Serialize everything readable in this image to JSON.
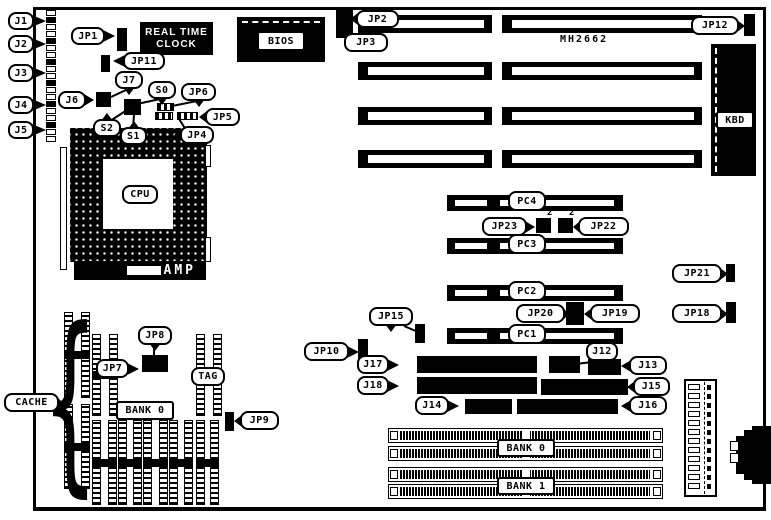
{
  "labels": {
    "chipset": "MH2662",
    "rtc_line1": "REAL TIME",
    "rtc_line2": "CLOCK",
    "amp": "AMP",
    "sup_jp23": "2",
    "sup_jp22": "2"
  },
  "callouts": [
    {
      "id": "j1",
      "label": "J1",
      "x": 8,
      "y": 12,
      "w": 26,
      "h": 18,
      "dir": "right",
      "len": 14
    },
    {
      "id": "j2",
      "label": "J2",
      "x": 8,
      "y": 35,
      "w": 26,
      "h": 18,
      "dir": "right",
      "len": 14
    },
    {
      "id": "j3",
      "label": "J3",
      "x": 8,
      "y": 64,
      "w": 26,
      "h": 18,
      "dir": "right",
      "len": 14
    },
    {
      "id": "j4",
      "label": "J4",
      "x": 8,
      "y": 96,
      "w": 26,
      "h": 18,
      "dir": "right",
      "len": 14
    },
    {
      "id": "j5",
      "label": "J5",
      "x": 8,
      "y": 121,
      "w": 26,
      "h": 18,
      "dir": "right",
      "len": 14
    },
    {
      "id": "jp1",
      "label": "JP1",
      "x": 71,
      "y": 27,
      "w": 34,
      "h": 18,
      "dir": "right",
      "len": 12
    },
    {
      "id": "jp11",
      "label": "JP11",
      "x": 123,
      "y": 52,
      "w": 42,
      "h": 18,
      "dir": "left",
      "len": 12
    },
    {
      "id": "j7",
      "label": "J7",
      "x": 115,
      "y": 71,
      "w": 28,
      "h": 18,
      "dir": "down",
      "len": 8
    },
    {
      "id": "j6",
      "label": "J6",
      "x": 58,
      "y": 91,
      "w": 28,
      "h": 18,
      "dir": "right",
      "len": 10
    },
    {
      "id": "s0",
      "label": "S0",
      "x": 148,
      "y": 81,
      "w": 28,
      "h": 18,
      "dir": "down",
      "len": 8
    },
    {
      "id": "jp6",
      "label": "JP6",
      "x": 181,
      "y": 83,
      "w": 35,
      "h": 18,
      "dir": "down",
      "len": 8
    },
    {
      "id": "jp5",
      "label": "JP5",
      "x": 205,
      "y": 108,
      "w": 35,
      "h": 18,
      "dir": "left",
      "len": 8
    },
    {
      "id": "s2",
      "label": "S2",
      "x": 93,
      "y": 119,
      "w": 28,
      "h": 18,
      "dir": "up",
      "len": 8
    },
    {
      "id": "s1",
      "label": "S1",
      "x": 120,
      "y": 127,
      "w": 27,
      "h": 18,
      "dir": "up",
      "len": 8
    },
    {
      "id": "jp4",
      "label": "JP4",
      "x": 180,
      "y": 126,
      "w": 34,
      "h": 18,
      "dir": "left",
      "len": 8
    },
    {
      "id": "jp2",
      "label": "JP2",
      "x": 356,
      "y": 10,
      "w": 43,
      "h": 18,
      "dir": "left",
      "len": 8
    },
    {
      "id": "jp3",
      "label": "JP3",
      "x": 344,
      "y": 33,
      "w": 44,
      "h": 19,
      "dir": "up",
      "len": 8
    },
    {
      "id": "jp12",
      "label": "JP12",
      "x": 691,
      "y": 16,
      "w": 48,
      "h": 19,
      "dir": "right",
      "len": 8
    },
    {
      "id": "jp23",
      "label": "JP23",
      "x": 482,
      "y": 217,
      "w": 45,
      "h": 19,
      "dir": "right",
      "len": 10
    },
    {
      "id": "jp22",
      "label": "JP22",
      "x": 578,
      "y": 217,
      "w": 51,
      "h": 19,
      "dir": "left",
      "len": 7
    },
    {
      "id": "jp21",
      "label": "JP21",
      "x": 672,
      "y": 264,
      "w": 50,
      "h": 19,
      "dir": "right",
      "len": 8
    },
    {
      "id": "jp20",
      "label": "JP20",
      "x": 516,
      "y": 304,
      "w": 49,
      "h": 19,
      "dir": "right",
      "len": 6
    },
    {
      "id": "jp19",
      "label": "JP19",
      "x": 590,
      "y": 304,
      "w": 50,
      "h": 19,
      "dir": "left",
      "len": 8
    },
    {
      "id": "jp18",
      "label": "JP18",
      "x": 672,
      "y": 304,
      "w": 50,
      "h": 19,
      "dir": "right",
      "len": 8
    },
    {
      "id": "jp15",
      "label": "JP15",
      "x": 369,
      "y": 307,
      "w": 44,
      "h": 19,
      "dir": "down",
      "len": 8
    },
    {
      "id": "jp10",
      "label": "JP10",
      "x": 304,
      "y": 342,
      "w": 45,
      "h": 19,
      "dir": "right",
      "len": 12
    },
    {
      "id": "j17",
      "label": "J17",
      "x": 357,
      "y": 355,
      "w": 32,
      "h": 19,
      "dir": "right",
      "len": 12
    },
    {
      "id": "j12",
      "label": "J12",
      "x": 586,
      "y": 342,
      "w": 32,
      "h": 19,
      "dir": "down",
      "len": 8
    },
    {
      "id": "j13",
      "label": "J13",
      "x": 629,
      "y": 356,
      "w": 38,
      "h": 19,
      "dir": "left",
      "len": 10
    },
    {
      "id": "j18",
      "label": "J18",
      "x": 357,
      "y": 376,
      "w": 32,
      "h": 19,
      "dir": "right",
      "len": 12
    },
    {
      "id": "j15",
      "label": "J15",
      "x": 633,
      "y": 377,
      "w": 37,
      "h": 19,
      "dir": "left",
      "len": 8
    },
    {
      "id": "j14",
      "label": "J14",
      "x": 415,
      "y": 396,
      "w": 34,
      "h": 19,
      "dir": "right",
      "len": 12
    },
    {
      "id": "j16",
      "label": "J16",
      "x": 629,
      "y": 396,
      "w": 38,
      "h": 19,
      "dir": "left",
      "len": 10
    },
    {
      "id": "jp7",
      "label": "JP7",
      "x": 96,
      "y": 359,
      "w": 33,
      "h": 19,
      "dir": "right",
      "len": 12
    },
    {
      "id": "jp8",
      "label": "JP8",
      "x": 138,
      "y": 326,
      "w": 34,
      "h": 19,
      "dir": "down",
      "len": 8
    },
    {
      "id": "jp9",
      "label": "JP9",
      "x": 240,
      "y": 411,
      "w": 39,
      "h": 19,
      "dir": "left",
      "len": 8
    },
    {
      "id": "cache",
      "label": "CACHE",
      "x": 4,
      "y": 393,
      "w": 55,
      "h": 19,
      "dir": "right",
      "len": 6
    },
    {
      "id": "tag",
      "label": "TAG",
      "x": 191,
      "y": 367,
      "w": 34,
      "h": 19,
      "dir": "none"
    },
    {
      "id": "cpu",
      "label": "CPU",
      "x": 122,
      "y": 185,
      "w": 36,
      "h": 19,
      "dir": "none"
    },
    {
      "id": "bios",
      "label": "BIOS",
      "x": 257,
      "y": 31,
      "w": 48,
      "h": 20,
      "dir": "none"
    },
    {
      "id": "kbd",
      "label": "KBD",
      "x": 716,
      "y": 111,
      "w": 38,
      "h": 18,
      "dir": "none"
    },
    {
      "id": "pc4",
      "label": "PC4",
      "x": 508,
      "y": 191,
      "w": 38,
      "h": 20,
      "dir": "none"
    },
    {
      "id": "pc3",
      "label": "PC3",
      "x": 508,
      "y": 234,
      "w": 38,
      "h": 20,
      "dir": "none"
    },
    {
      "id": "pc2",
      "label": "PC2",
      "x": 508,
      "y": 281,
      "w": 38,
      "h": 20,
      "dir": "none"
    },
    {
      "id": "pc1",
      "label": "PC1",
      "x": 508,
      "y": 324,
      "w": 38,
      "h": 20,
      "dir": "none"
    },
    {
      "id": "bank0-cache",
      "label": "BANK 0",
      "x": 116,
      "y": 401,
      "w": 58,
      "h": 19,
      "dir": "none"
    },
    {
      "id": "bank0",
      "label": "BANK 0",
      "x": 497,
      "y": 439,
      "w": 58,
      "h": 18,
      "dir": "none"
    },
    {
      "id": "bank1",
      "label": "BANK 1",
      "x": 497,
      "y": 477,
      "w": 58,
      "h": 18,
      "dir": "none"
    }
  ],
  "jumpers": [
    {
      "id": "jp1-j",
      "x": 117,
      "y": 28,
      "w": 10,
      "h": 23,
      "t": "v"
    },
    {
      "id": "jp11-j",
      "x": 101,
      "y": 55,
      "w": 9,
      "h": 17,
      "t": "v"
    },
    {
      "id": "j6-j",
      "x": 96,
      "y": 92,
      "w": 15,
      "h": 15,
      "t": "g"
    },
    {
      "id": "s-block",
      "x": 124,
      "y": 99,
      "w": 17,
      "h": 16,
      "t": "g"
    },
    {
      "id": "jp6-j",
      "x": 157,
      "y": 103,
      "w": 17,
      "h": 8,
      "t": "h"
    },
    {
      "id": "jp5-j1",
      "x": 155,
      "y": 112,
      "w": 18,
      "h": 8,
      "t": "h"
    },
    {
      "id": "jp5-j2",
      "x": 177,
      "y": 112,
      "w": 21,
      "h": 8,
      "t": "h"
    },
    {
      "id": "jp2-j",
      "x": 336,
      "y": 8,
      "w": 17,
      "h": 30,
      "t": "v"
    },
    {
      "id": "jp12-j",
      "x": 744,
      "y": 14,
      "w": 11,
      "h": 22,
      "t": "v"
    },
    {
      "id": "jp23-j",
      "x": 536,
      "y": 218,
      "w": 15,
      "h": 15,
      "t": "g"
    },
    {
      "id": "jp22-j",
      "x": 558,
      "y": 218,
      "w": 15,
      "h": 15,
      "t": "g"
    },
    {
      "id": "jp21-j",
      "x": 726,
      "y": 264,
      "w": 9,
      "h": 18,
      "t": "v"
    },
    {
      "id": "jp20-j",
      "x": 566,
      "y": 302,
      "w": 18,
      "h": 23,
      "t": "v"
    },
    {
      "id": "jp18-j",
      "x": 726,
      "y": 302,
      "w": 10,
      "h": 21,
      "t": "v"
    },
    {
      "id": "jp15-j",
      "x": 415,
      "y": 324,
      "w": 10,
      "h": 19,
      "t": "v"
    },
    {
      "id": "jp10-j",
      "x": 358,
      "y": 339,
      "w": 10,
      "h": 24,
      "t": "v"
    },
    {
      "id": "jp78-j",
      "x": 142,
      "y": 355,
      "w": 26,
      "h": 17,
      "t": "g"
    },
    {
      "id": "jp9-j",
      "x": 225,
      "y": 412,
      "w": 9,
      "h": 19,
      "t": "v"
    }
  ],
  "headers": [
    {
      "id": "j17-h",
      "x": 417,
      "y": 356,
      "w": 120,
      "h": 17,
      "cols": 15
    },
    {
      "id": "j12-h",
      "x": 549,
      "y": 356,
      "w": 31,
      "h": 17,
      "cols": 4
    },
    {
      "id": "j13-h",
      "x": 588,
      "y": 359,
      "w": 33,
      "h": 16,
      "cols": 4
    },
    {
      "id": "j18-h",
      "x": 417,
      "y": 377,
      "w": 120,
      "h": 17,
      "cols": 15
    },
    {
      "id": "j15-h",
      "x": 541,
      "y": 379,
      "w": 87,
      "h": 16,
      "cols": 11
    },
    {
      "id": "j14-h",
      "x": 465,
      "y": 399,
      "w": 47,
      "h": 15,
      "cols": 6
    },
    {
      "id": "j16-h",
      "x": 517,
      "y": 399,
      "w": 101,
      "h": 15,
      "cols": 13
    }
  ],
  "isa_slots": [
    {
      "x": 358,
      "y": 15,
      "w": 134,
      "h": 18
    },
    {
      "x": 502,
      "y": 15,
      "w": 200,
      "h": 18
    },
    {
      "x": 358,
      "y": 62,
      "w": 134,
      "h": 18
    },
    {
      "x": 502,
      "y": 62,
      "w": 200,
      "h": 18
    },
    {
      "x": 358,
      "y": 107,
      "w": 134,
      "h": 18
    },
    {
      "x": 502,
      "y": 107,
      "w": 200,
      "h": 18
    },
    {
      "x": 358,
      "y": 150,
      "w": 134,
      "h": 18
    },
    {
      "x": 502,
      "y": 150,
      "w": 200,
      "h": 18
    }
  ],
  "pci_slots": [
    {
      "x": 447,
      "y": 195,
      "w": 176,
      "h": 16
    },
    {
      "x": 447,
      "y": 238,
      "w": 176,
      "h": 16
    },
    {
      "x": 447,
      "y": 285,
      "w": 176,
      "h": 16
    },
    {
      "x": 447,
      "y": 328,
      "w": 176,
      "h": 16
    }
  ],
  "simm_slots": [
    {
      "x": 388,
      "y": 428,
      "w": 275,
      "h": 15
    },
    {
      "x": 388,
      "y": 446,
      "w": 275,
      "h": 15
    },
    {
      "x": 388,
      "y": 467,
      "w": 275,
      "h": 15
    },
    {
      "x": 388,
      "y": 484,
      "w": 275,
      "h": 15
    }
  ],
  "cache_chips": [
    {
      "x": 64,
      "y": 312,
      "w": 26,
      "h": 86
    },
    {
      "x": 64,
      "y": 404,
      "w": 26,
      "h": 85
    },
    {
      "x": 92,
      "y": 334,
      "w": 26,
      "h": 82
    },
    {
      "x": 196,
      "y": 334,
      "w": 26,
      "h": 82
    },
    {
      "x": 92,
      "y": 420,
      "w": 25,
      "h": 85
    },
    {
      "x": 118,
      "y": 420,
      "w": 24,
      "h": 85
    },
    {
      "x": 143,
      "y": 420,
      "w": 25,
      "h": 85
    },
    {
      "x": 169,
      "y": 420,
      "w": 24,
      "h": 85
    },
    {
      "x": 196,
      "y": 420,
      "w": 23,
      "h": 85
    }
  ],
  "bars": [
    {
      "x": 60,
      "y": 147,
      "w": 7,
      "h": 123
    },
    {
      "x": 205,
      "y": 145,
      "w": 6,
      "h": 22
    },
    {
      "x": 205,
      "y": 237,
      "w": 6,
      "h": 25
    }
  ],
  "edge_strip": {
    "x": 46,
    "y": 10,
    "cell_w": 10,
    "cell_h": 6,
    "gap": 1,
    "count": 19
  },
  "power_connector": {
    "x": 684,
    "y": 379,
    "w": 33,
    "h": 118,
    "cells": 12
  },
  "lines": [
    [
      160,
      99,
      137,
      104
    ],
    [
      110,
      121,
      127,
      110
    ],
    [
      133,
      128,
      134,
      115
    ],
    [
      128,
      89,
      111,
      97
    ],
    [
      197,
      101,
      172,
      106
    ],
    [
      353,
      34,
      347,
      27
    ],
    [
      600,
      361,
      576,
      364
    ],
    [
      154,
      345,
      154,
      357
    ],
    [
      404,
      326,
      418,
      332
    ],
    [
      188,
      133,
      179,
      119
    ]
  ]
}
